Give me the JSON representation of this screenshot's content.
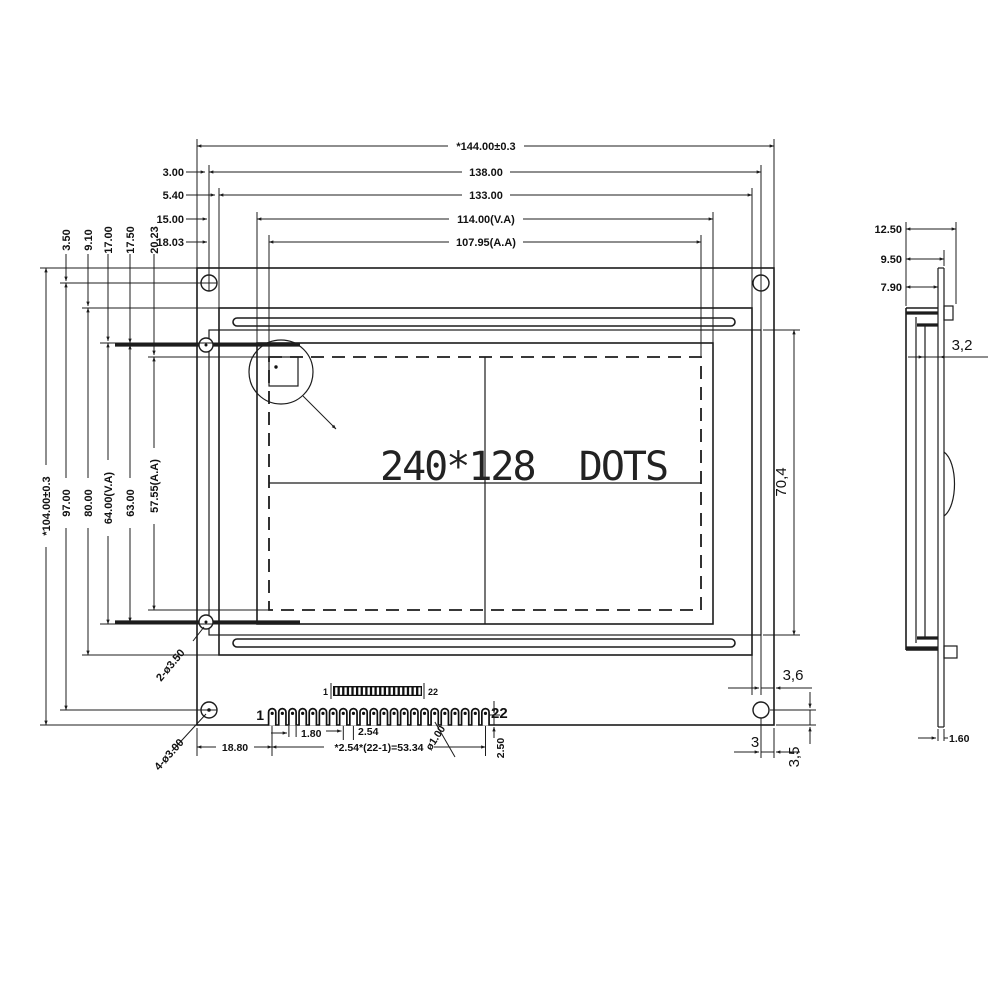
{
  "display": {
    "label": "240*128  DOTS"
  },
  "dims": {
    "w_total": "*144.00±0.3",
    "w_holes": "138.00",
    "w_bezel": "133.00",
    "w_va": "114.00(V.A)",
    "w_aa": "107.95(A.A)",
    "off_3": "3.00",
    "off_54": "5.40",
    "off_15": "15.00",
    "off_1803": "18.03",
    "h_total": "*104.00±0.3",
    "h_holes": "97.00",
    "h_bezel": "80.00",
    "h_va": "64.00(V.A)",
    "h_63": "63.00",
    "h_aa": "57.55(A.A)",
    "voff_350": "3.50",
    "voff_910": "9.10",
    "voff_1700": "17.00",
    "voff_1750": "17.50",
    "voff_2023": "20.23",
    "holes_side": "2-ø3.50",
    "holes_corner": "4-ø3.00",
    "glass_h": "70,4",
    "edge_gap": "3,6",
    "hole_edge": "3",
    "hole_bottom": "3,5"
  },
  "connector": {
    "count": 22,
    "first": "1",
    "last": "22",
    "strip_first": "1",
    "strip_last": "22",
    "pin1_offset": "18.80",
    "pad_width": "1.80",
    "pitch": "2.54",
    "pitch_total": "*2.54*(22-1)=53.34",
    "hole_dia": "ø1.00",
    "pin_length": "2.50"
  },
  "side": {
    "d125": "12.50",
    "d95": "9.50",
    "d79": "7.90",
    "stack": "3,2",
    "pcb_t": "1.60"
  }
}
